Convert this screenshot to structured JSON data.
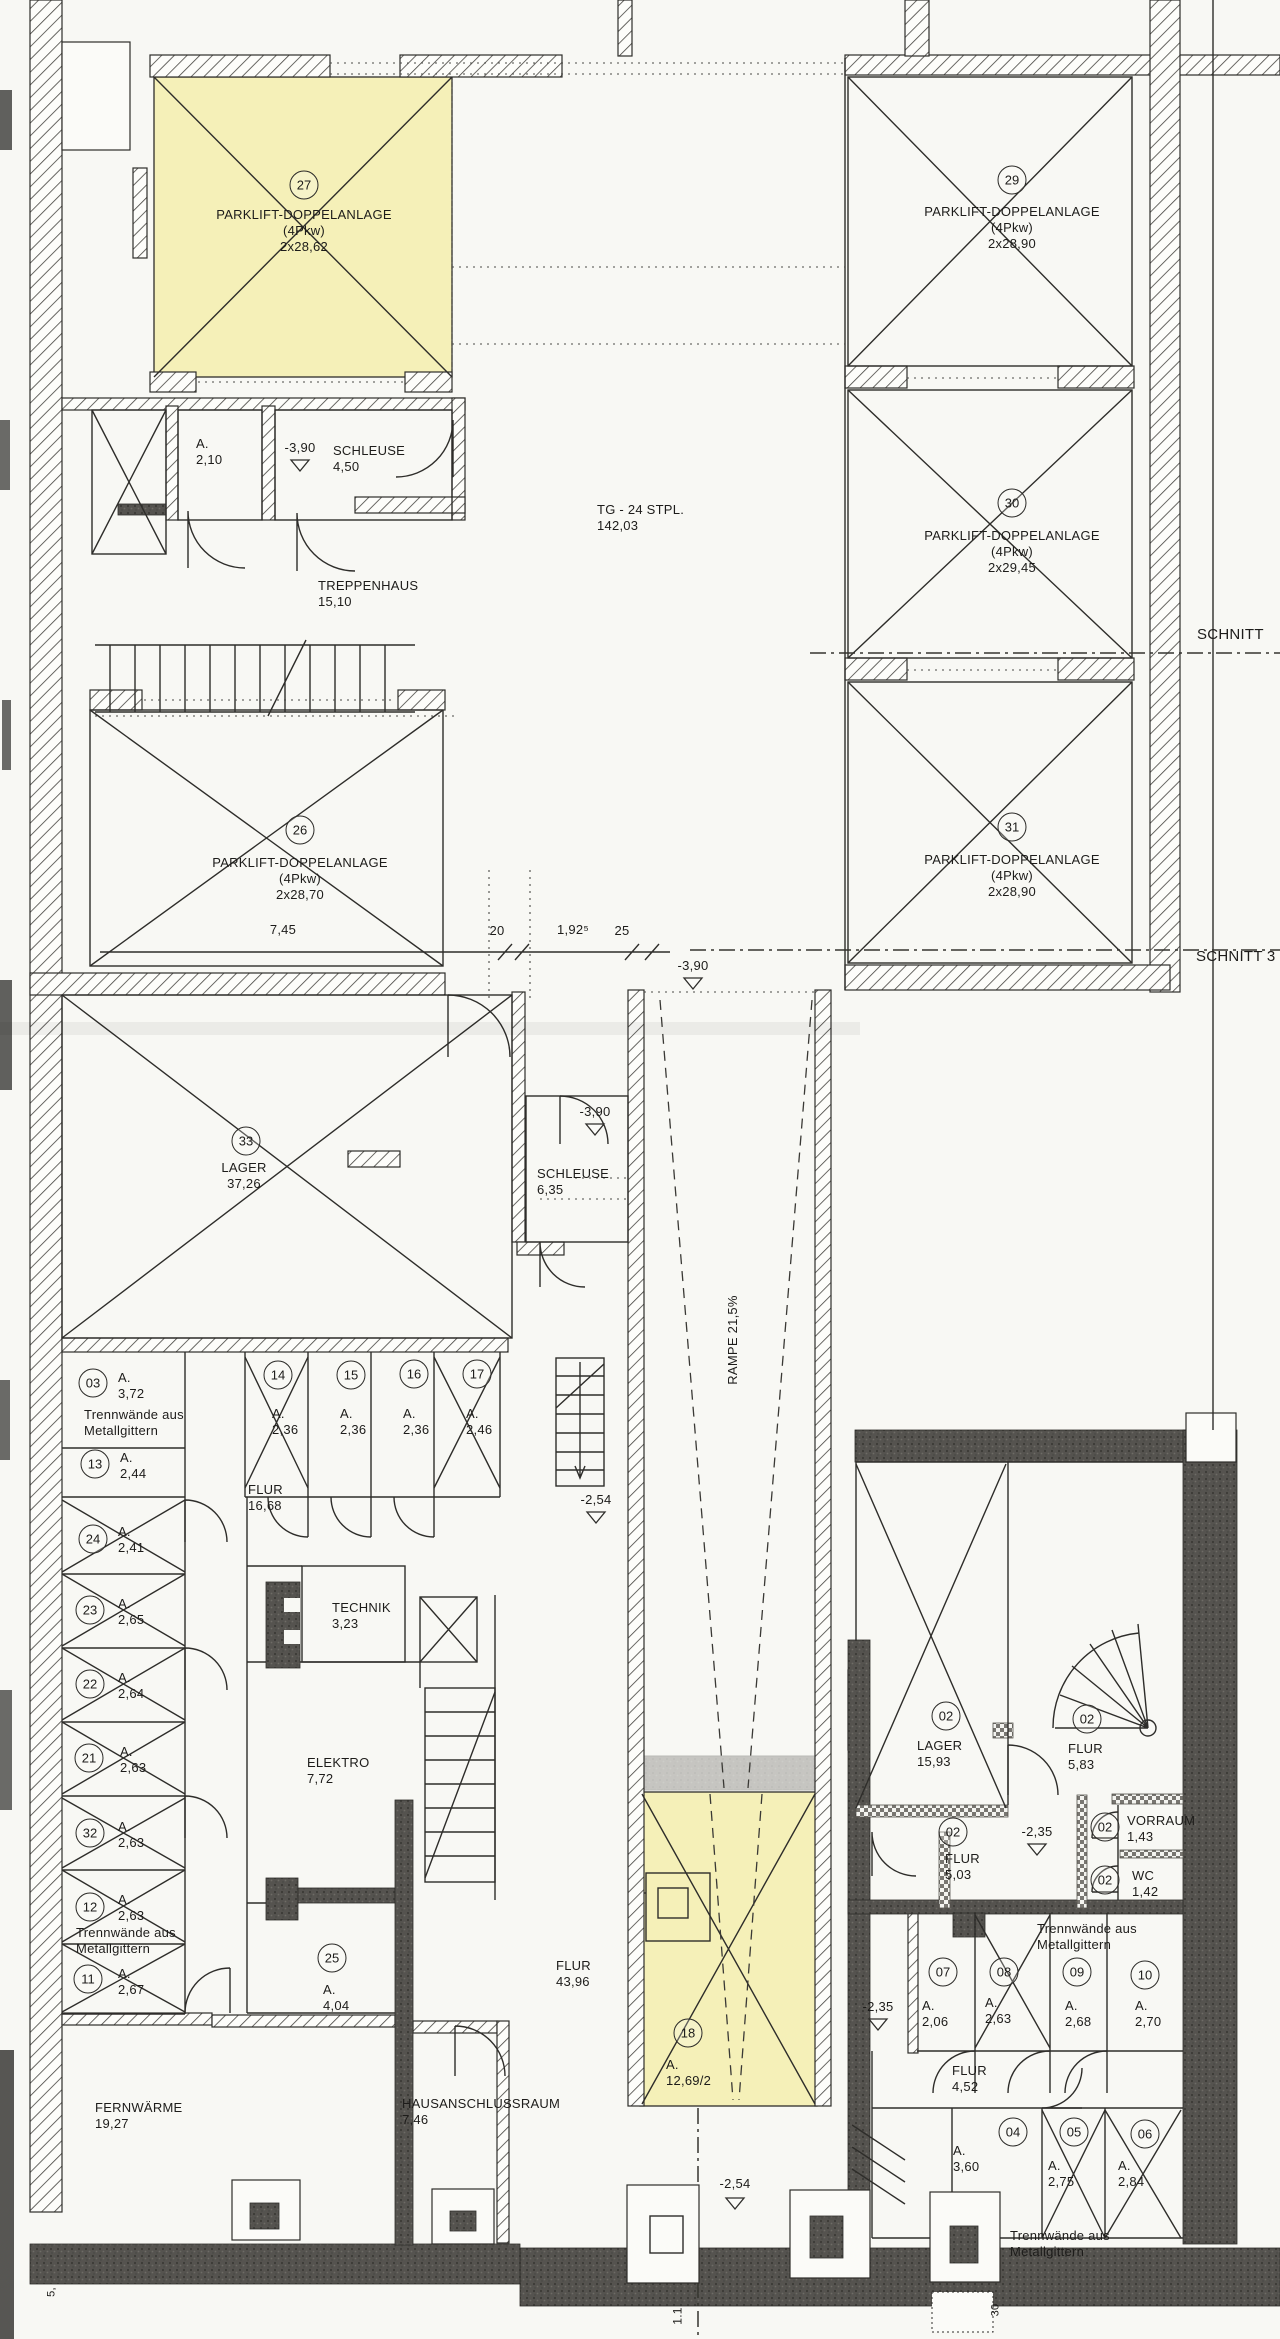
{
  "document": {
    "kind": "architectural-floor-plan",
    "language": "de",
    "description": "Untergeschoss / Tiefgarage mit Parklift-Doppelanlagen und Kellerabteilen"
  },
  "colors": {
    "paper": "#f8f8f4",
    "highlight_yellow": "#f5f0b8",
    "line": "#2e2d2a",
    "dark_wall": "#54524e"
  },
  "labels": [
    {
      "id": "room-27-number",
      "kind": "circle",
      "x": 304,
      "y": 185,
      "n": "27"
    },
    {
      "id": "room-27-label",
      "kind": "text",
      "x": 304,
      "y": 207,
      "lines": [
        "PARKLIFT-DOPPELANLAGE",
        "(4Pkw)",
        "2x28,62"
      ]
    },
    {
      "id": "room-29-number",
      "kind": "circle",
      "x": 1012,
      "y": 180,
      "n": "29"
    },
    {
      "id": "room-29-label",
      "kind": "text",
      "x": 1012,
      "y": 204,
      "lines": [
        "PARKLIFT-DOPPELANLAGE",
        "(4Pkw)",
        "2x28,90"
      ]
    },
    {
      "id": "room-30-number",
      "kind": "circle",
      "x": 1012,
      "y": 503,
      "n": "30"
    },
    {
      "id": "room-30-label",
      "kind": "text",
      "x": 1012,
      "y": 528,
      "lines": [
        "PARKLIFT-DOPPELANLAGE",
        "(4Pkw)",
        "2x29,45"
      ]
    },
    {
      "id": "room-26-number",
      "kind": "circle",
      "x": 300,
      "y": 830,
      "n": "26"
    },
    {
      "id": "room-26-label",
      "kind": "text",
      "x": 300,
      "y": 855,
      "lines": [
        "PARKLIFT-DOPPELANLAGE",
        "(4Pkw)",
        "2x28,70"
      ]
    },
    {
      "id": "room-31-number",
      "kind": "circle",
      "x": 1012,
      "y": 827,
      "n": "31"
    },
    {
      "id": "room-31-label",
      "kind": "text",
      "x": 1012,
      "y": 852,
      "lines": [
        "PARKLIFT-DOPPELANLAGE",
        "(4Pkw)",
        "2x28,90"
      ]
    },
    {
      "id": "garage-label",
      "kind": "text",
      "x": 597,
      "y": 502,
      "align": "l",
      "lines": [
        "TG - 24 STPL.",
        "142,03"
      ]
    },
    {
      "id": "room-a210-label",
      "kind": "text",
      "x": 196,
      "y": 436,
      "align": "l",
      "lines": [
        "A.",
        "2,10"
      ]
    },
    {
      "id": "level-marker-390-a",
      "kind": "text",
      "x": 300,
      "y": 440,
      "lines": [
        "-3,90"
      ]
    },
    {
      "id": "schleuse-450-label",
      "kind": "text",
      "x": 333,
      "y": 443,
      "align": "l",
      "lines": [
        "SCHLEUSE",
        "4,50"
      ]
    },
    {
      "id": "treppenhaus-label",
      "kind": "text",
      "x": 318,
      "y": 578,
      "align": "l",
      "lines": [
        "TREPPENHAUS",
        "15,10"
      ]
    },
    {
      "id": "schnitt-upper-label",
      "kind": "text",
      "x": 1197,
      "y": 626,
      "align": "l",
      "size": 15,
      "lines": [
        "SCHNITT"
      ]
    },
    {
      "id": "schnitt-lower-label",
      "kind": "text",
      "x": 1196,
      "y": 948,
      "align": "l",
      "size": 15,
      "lines": [
        "SCHNITT 3"
      ]
    },
    {
      "id": "dim-745",
      "kind": "text",
      "x": 283,
      "y": 922,
      "lines": [
        "7,45"
      ]
    },
    {
      "id": "dim-20",
      "kind": "text",
      "x": 497,
      "y": 923,
      "lines": [
        "20"
      ]
    },
    {
      "id": "dim-192",
      "kind": "text",
      "x": 573,
      "y": 922,
      "lines": [
        "1,92⁵"
      ]
    },
    {
      "id": "dim-25",
      "kind": "text",
      "x": 622,
      "y": 923,
      "lines": [
        "25"
      ]
    },
    {
      "id": "level-marker-390-b",
      "kind": "text",
      "x": 693,
      "y": 958,
      "lines": [
        "-3,90"
      ]
    },
    {
      "id": "level-marker-390-c",
      "kind": "text",
      "x": 595,
      "y": 1104,
      "lines": [
        "-3,90"
      ]
    },
    {
      "id": "room-33-number",
      "kind": "circle",
      "x": 246,
      "y": 1141,
      "n": "33"
    },
    {
      "id": "room-33-label",
      "kind": "text",
      "x": 244,
      "y": 1160,
      "lines": [
        "LAGER",
        "37,26"
      ]
    },
    {
      "id": "schleuse-635-label",
      "kind": "text",
      "x": 537,
      "y": 1166,
      "align": "l",
      "lines": [
        "SCHLEUSE",
        "6,35"
      ]
    },
    {
      "id": "rampe-label",
      "kind": "text",
      "x": 733,
      "y": 1340,
      "rot": -90,
      "lines": [
        "RAMPE 21,5%"
      ]
    },
    {
      "id": "room-03-number",
      "kind": "circle",
      "x": 93,
      "y": 1383,
      "n": "03"
    },
    {
      "id": "room-03-label",
      "kind": "text",
      "x": 118,
      "y": 1370,
      "align": "l",
      "lines": [
        "A.",
        "3,72"
      ]
    },
    {
      "id": "trennwaende-note-1",
      "kind": "text",
      "x": 84,
      "y": 1407,
      "align": "l",
      "lines": [
        "Trennwände aus",
        "Metallgittern"
      ]
    },
    {
      "id": "room-13-number",
      "kind": "circle",
      "x": 95,
      "y": 1464,
      "n": "13"
    },
    {
      "id": "room-13-label",
      "kind": "text",
      "x": 120,
      "y": 1450,
      "align": "l",
      "lines": [
        "A.",
        "2,44"
      ]
    },
    {
      "id": "room-14-number",
      "kind": "circle",
      "x": 278,
      "y": 1375,
      "n": "14"
    },
    {
      "id": "room-14-label",
      "kind": "text",
      "x": 272,
      "y": 1406,
      "align": "l",
      "lines": [
        "A.",
        "2,36"
      ]
    },
    {
      "id": "room-15-number",
      "kind": "circle",
      "x": 351,
      "y": 1375,
      "n": "15"
    },
    {
      "id": "room-15-label",
      "kind": "text",
      "x": 340,
      "y": 1406,
      "align": "l",
      "lines": [
        "A.",
        "2,36"
      ]
    },
    {
      "id": "room-16-number",
      "kind": "circle",
      "x": 414,
      "y": 1374,
      "n": "16"
    },
    {
      "id": "room-16-label",
      "kind": "text",
      "x": 403,
      "y": 1406,
      "align": "l",
      "lines": [
        "A.",
        "2,36"
      ]
    },
    {
      "id": "room-17-number",
      "kind": "circle",
      "x": 477,
      "y": 1374,
      "n": "17"
    },
    {
      "id": "room-17-label",
      "kind": "text",
      "x": 466,
      "y": 1406,
      "align": "l",
      "lines": [
        "A.",
        "2,46"
      ]
    },
    {
      "id": "flur-1668-label",
      "kind": "text",
      "x": 248,
      "y": 1482,
      "align": "l",
      "lines": [
        "FLUR",
        "16,68"
      ]
    },
    {
      "id": "room-24-number",
      "kind": "circle",
      "x": 93,
      "y": 1539,
      "n": "24"
    },
    {
      "id": "room-24-label",
      "kind": "text",
      "x": 118,
      "y": 1524,
      "align": "l",
      "lines": [
        "A.",
        "2,41"
      ]
    },
    {
      "id": "room-23-number",
      "kind": "circle",
      "x": 90,
      "y": 1610,
      "n": "23"
    },
    {
      "id": "room-23-label",
      "kind": "text",
      "x": 118,
      "y": 1596,
      "align": "l",
      "lines": [
        "A.",
        "2,65"
      ]
    },
    {
      "id": "technik-label",
      "kind": "text",
      "x": 332,
      "y": 1600,
      "align": "l",
      "lines": [
        "TECHNIK",
        "3,23"
      ]
    },
    {
      "id": "room-22-number",
      "kind": "circle",
      "x": 90,
      "y": 1684,
      "n": "22"
    },
    {
      "id": "room-22-label",
      "kind": "text",
      "x": 118,
      "y": 1670,
      "align": "l",
      "lines": [
        "A.",
        "2,64"
      ]
    },
    {
      "id": "room-21-number",
      "kind": "circle",
      "x": 89,
      "y": 1758,
      "n": "21"
    },
    {
      "id": "room-21-label",
      "kind": "text",
      "x": 120,
      "y": 1744,
      "align": "l",
      "lines": [
        "A.",
        "2,63"
      ]
    },
    {
      "id": "elektro-label",
      "kind": "text",
      "x": 307,
      "y": 1755,
      "align": "l",
      "lines": [
        "ELEKTRO",
        "7,72"
      ]
    },
    {
      "id": "room-32-number",
      "kind": "circle",
      "x": 90,
      "y": 1833,
      "n": "32"
    },
    {
      "id": "room-32-label",
      "kind": "text",
      "x": 118,
      "y": 1819,
      "align": "l",
      "lines": [
        "A.",
        "2,63"
      ]
    },
    {
      "id": "room-12-number",
      "kind": "circle",
      "x": 90,
      "y": 1907,
      "n": "12"
    },
    {
      "id": "room-12-label",
      "kind": "text",
      "x": 118,
      "y": 1892,
      "align": "l",
      "lines": [
        "A.",
        "2,63"
      ]
    },
    {
      "id": "trennwaende-note-2",
      "kind": "text",
      "x": 76,
      "y": 1925,
      "align": "l",
      "lines": [
        "Trennwände aus",
        "Metallgittern"
      ]
    },
    {
      "id": "room-11-number",
      "kind": "circle",
      "x": 88,
      "y": 1979,
      "n": "11"
    },
    {
      "id": "room-11-label",
      "kind": "text",
      "x": 118,
      "y": 1966,
      "align": "l",
      "lines": [
        "A.",
        "2,67"
      ]
    },
    {
      "id": "room-25-number",
      "kind": "circle",
      "x": 332,
      "y": 1958,
      "n": "25"
    },
    {
      "id": "room-25-label",
      "kind": "text",
      "x": 323,
      "y": 1982,
      "align": "l",
      "lines": [
        "A.",
        "4,04"
      ]
    },
    {
      "id": "level-marker-254-a",
      "kind": "text",
      "x": 596,
      "y": 1492,
      "lines": [
        "-2,54"
      ]
    },
    {
      "id": "flur-4396-label",
      "kind": "text",
      "x": 556,
      "y": 1958,
      "align": "l",
      "lines": [
        "FLUR",
        "43,96"
      ]
    },
    {
      "id": "room-18-number",
      "kind": "circle",
      "x": 688,
      "y": 2033,
      "n": "18"
    },
    {
      "id": "room-18-label",
      "kind": "text",
      "x": 666,
      "y": 2057,
      "align": "l",
      "lines": [
        "A.",
        "12,69/2"
      ]
    },
    {
      "id": "fernwaerme-label",
      "kind": "text",
      "x": 95,
      "y": 2100,
      "align": "l",
      "lines": [
        "FERNWÄRME",
        "19,27"
      ]
    },
    {
      "id": "hausanschlussraum-label",
      "kind": "text",
      "x": 402,
      "y": 2096,
      "align": "l",
      "lines": [
        "HAUSANSCHLUSSRAUM",
        "7,46"
      ]
    },
    {
      "id": "level-marker-254-b",
      "kind": "text",
      "x": 735,
      "y": 2176,
      "lines": [
        "-2,54"
      ]
    },
    {
      "id": "room-02a-number",
      "kind": "circle",
      "x": 946,
      "y": 1716,
      "n": "02"
    },
    {
      "id": "lager-02-label",
      "kind": "text",
      "x": 917,
      "y": 1738,
      "align": "l",
      "lines": [
        "LAGER",
        "15,93"
      ]
    },
    {
      "id": "room-02b-number",
      "kind": "circle",
      "x": 1087,
      "y": 1719,
      "n": "02"
    },
    {
      "id": "flur-583-label",
      "kind": "text",
      "x": 1068,
      "y": 1741,
      "align": "l",
      "lines": [
        "FLUR",
        "5,83"
      ]
    },
    {
      "id": "level-marker-235-a",
      "kind": "text",
      "x": 1037,
      "y": 1824,
      "lines": [
        "-2,35"
      ]
    },
    {
      "id": "room-02c-number",
      "kind": "circle",
      "x": 953,
      "y": 1832,
      "n": "02"
    },
    {
      "id": "flur-503-label",
      "kind": "text",
      "x": 945,
      "y": 1851,
      "align": "l",
      "lines": [
        "FLUR",
        "5,03"
      ]
    },
    {
      "id": "room-02d-number",
      "kind": "circle",
      "x": 1105,
      "y": 1827,
      "n": "02"
    },
    {
      "id": "vorraum-label",
      "kind": "text",
      "x": 1127,
      "y": 1813,
      "align": "l",
      "lines": [
        "VORRAUM",
        "1,43"
      ]
    },
    {
      "id": "room-02e-number",
      "kind": "circle",
      "x": 1105,
      "y": 1880,
      "n": "02"
    },
    {
      "id": "wc-label",
      "kind": "text",
      "x": 1132,
      "y": 1868,
      "align": "l",
      "lines": [
        "WC",
        "1,42"
      ]
    },
    {
      "id": "trennwaende-note-3",
      "kind": "text",
      "x": 1037,
      "y": 1921,
      "align": "l",
      "lines": [
        "Trennwände aus",
        "Metallgittern"
      ]
    },
    {
      "id": "room-07-number",
      "kind": "circle",
      "x": 943,
      "y": 1972,
      "n": "07"
    },
    {
      "id": "room-07-label",
      "kind": "text",
      "x": 922,
      "y": 1998,
      "align": "l",
      "lines": [
        "A.",
        "2,06"
      ]
    },
    {
      "id": "room-08-number",
      "kind": "circle",
      "x": 1004,
      "y": 1972,
      "n": "08"
    },
    {
      "id": "room-08-label",
      "kind": "text",
      "x": 985,
      "y": 1995,
      "align": "l",
      "lines": [
        "A.",
        "2,63"
      ]
    },
    {
      "id": "room-09-number",
      "kind": "circle",
      "x": 1077,
      "y": 1972,
      "n": "09"
    },
    {
      "id": "room-09-label",
      "kind": "text",
      "x": 1065,
      "y": 1998,
      "align": "l",
      "lines": [
        "A.",
        "2,68"
      ]
    },
    {
      "id": "room-10-number",
      "kind": "circle",
      "x": 1145,
      "y": 1975,
      "n": "10"
    },
    {
      "id": "room-10-label",
      "kind": "text",
      "x": 1135,
      "y": 1998,
      "align": "l",
      "lines": [
        "A.",
        "2,70"
      ]
    },
    {
      "id": "level-marker-235-b",
      "kind": "text",
      "x": 878,
      "y": 1999,
      "lines": [
        "-2,35"
      ]
    },
    {
      "id": "flur-452-label",
      "kind": "text",
      "x": 952,
      "y": 2063,
      "align": "l",
      "lines": [
        "FLUR",
        "4,52"
      ]
    },
    {
      "id": "room-04-number",
      "kind": "circle",
      "x": 1013,
      "y": 2132,
      "n": "04"
    },
    {
      "id": "room-04-label",
      "kind": "text",
      "x": 953,
      "y": 2143,
      "align": "l",
      "lines": [
        "A.",
        "3,60"
      ]
    },
    {
      "id": "room-05-number",
      "kind": "circle",
      "x": 1074,
      "y": 2132,
      "n": "05"
    },
    {
      "id": "room-05-label",
      "kind": "text",
      "x": 1048,
      "y": 2158,
      "align": "l",
      "lines": [
        "A.",
        "2,75"
      ]
    },
    {
      "id": "room-06-number",
      "kind": "circle",
      "x": 1145,
      "y": 2134,
      "n": "06"
    },
    {
      "id": "room-06-label",
      "kind": "text",
      "x": 1118,
      "y": 2158,
      "align": "l",
      "lines": [
        "A.",
        "2,84"
      ]
    },
    {
      "id": "trennwaende-note-4",
      "kind": "text",
      "x": 1010,
      "y": 2228,
      "align": "l",
      "lines": [
        "Trennwände aus",
        "Metallgittern"
      ]
    },
    {
      "id": "section-11-label",
      "kind": "text",
      "x": 678,
      "y": 2316,
      "rot": -90,
      "size": 12,
      "lines": [
        "1.1"
      ]
    },
    {
      "id": "dim-30-rot",
      "kind": "text",
      "x": 996,
      "y": 2310,
      "rot": -90,
      "size": 11,
      "lines": [
        "30"
      ]
    },
    {
      "id": "dim-5-rot",
      "kind": "text",
      "x": 52,
      "y": 2292,
      "rot": -90,
      "size": 11,
      "lines": [
        "5,"
      ]
    }
  ]
}
